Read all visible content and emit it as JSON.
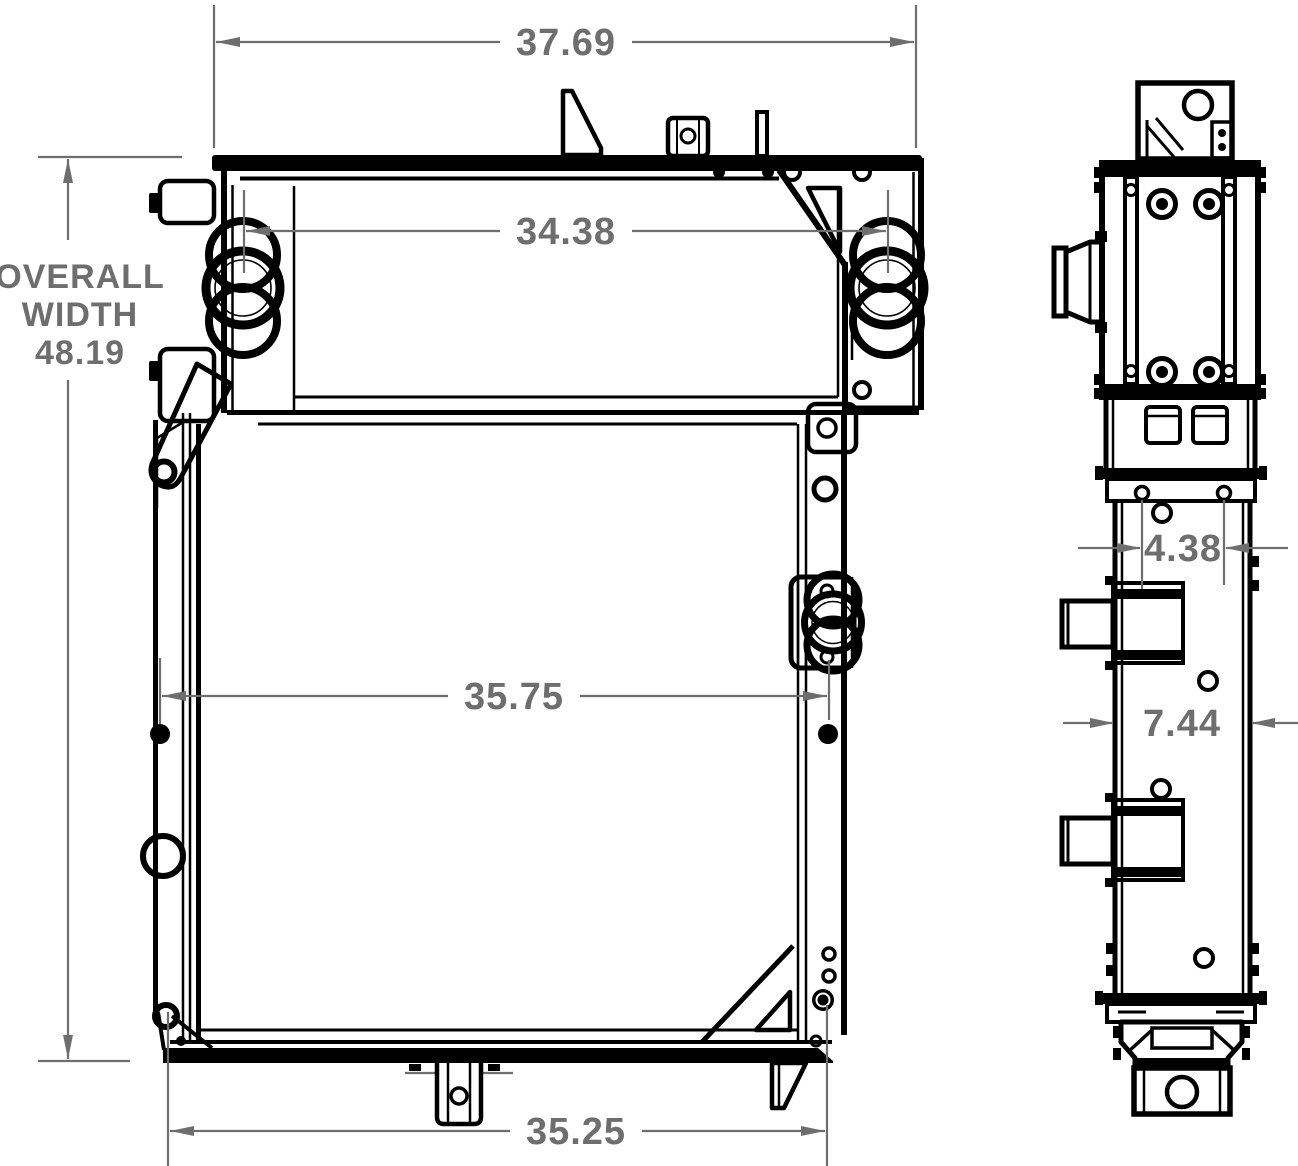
{
  "drawing": {
    "background_color": "#ffffff",
    "line_color": "#000000",
    "dimension_color": "#6e6e6e",
    "dimensions": {
      "top_flange_width": "37.69",
      "port_center_distance": "34.38",
      "overall_width_label_1": "OVERALL",
      "overall_width_label_2": "WIDTH",
      "overall_width": "48.19",
      "core_width": "35.75",
      "mounting_width": "35.25",
      "fitting_offset": "4.38",
      "overall_depth": "7.44"
    }
  }
}
